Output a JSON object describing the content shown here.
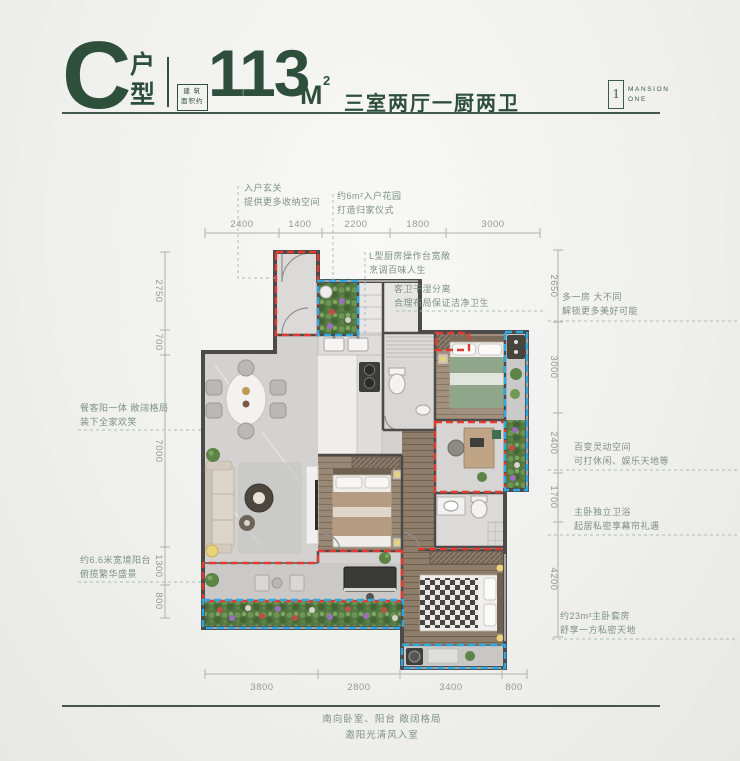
{
  "header": {
    "unit_letter": "C",
    "unit_label": "户\n型",
    "area_prefix": "建 筑\n面积约",
    "area_value": "113",
    "area_unit": "M",
    "area_exponent": "2",
    "layout_text": "三室两厅一厨两卫"
  },
  "logo": {
    "icon_digit": "1",
    "name_line1": "MANSION",
    "name_line2": "ONE"
  },
  "annotations": {
    "entry_foyer": "入户玄关\n提供更多收纳空间",
    "entry_garden": "约6m²入户花园\n打造归家仪式",
    "kitchen": "L型厨房操作台宽敞\n烹调百味人生",
    "guest_bath": "客卫干湿分离\n合理布局保证洁净卫生",
    "extra_room": "多一房 大不同\n解锁更多美好可能",
    "flex_space": "百变灵动空间\n可打休闲、娱乐天地等",
    "master_bath": "主卧独立卫浴\n起居私密享幕帘礼遇",
    "master_suite": "约23m²主卧套房\n舒享一方私密天地",
    "dining_balcony": "餐客阳一体 敞阔格局\n装下全家欢笑",
    "wide_balcony": "约6.6米宽境阳台\n俯揽繁华盛景",
    "south_caption": "南向卧室、阳台 敞阔格局\n邀阳光清风入室"
  },
  "dimensions": {
    "top": [
      "2400",
      "1400",
      "2200",
      "1800",
      "3000"
    ],
    "left": [
      "2750",
      "700",
      "7000",
      "1300",
      "800"
    ],
    "right": [
      "2650",
      "3000",
      "2400",
      "1700",
      "4200"
    ],
    "bottom": [
      "3800",
      "2800",
      "3400",
      "800"
    ]
  },
  "colors": {
    "brand_green": "#2f4f3d",
    "note_green": "#7e9184",
    "highlight_red": "#e23b31",
    "highlight_blue": "#2fa8e0"
  }
}
